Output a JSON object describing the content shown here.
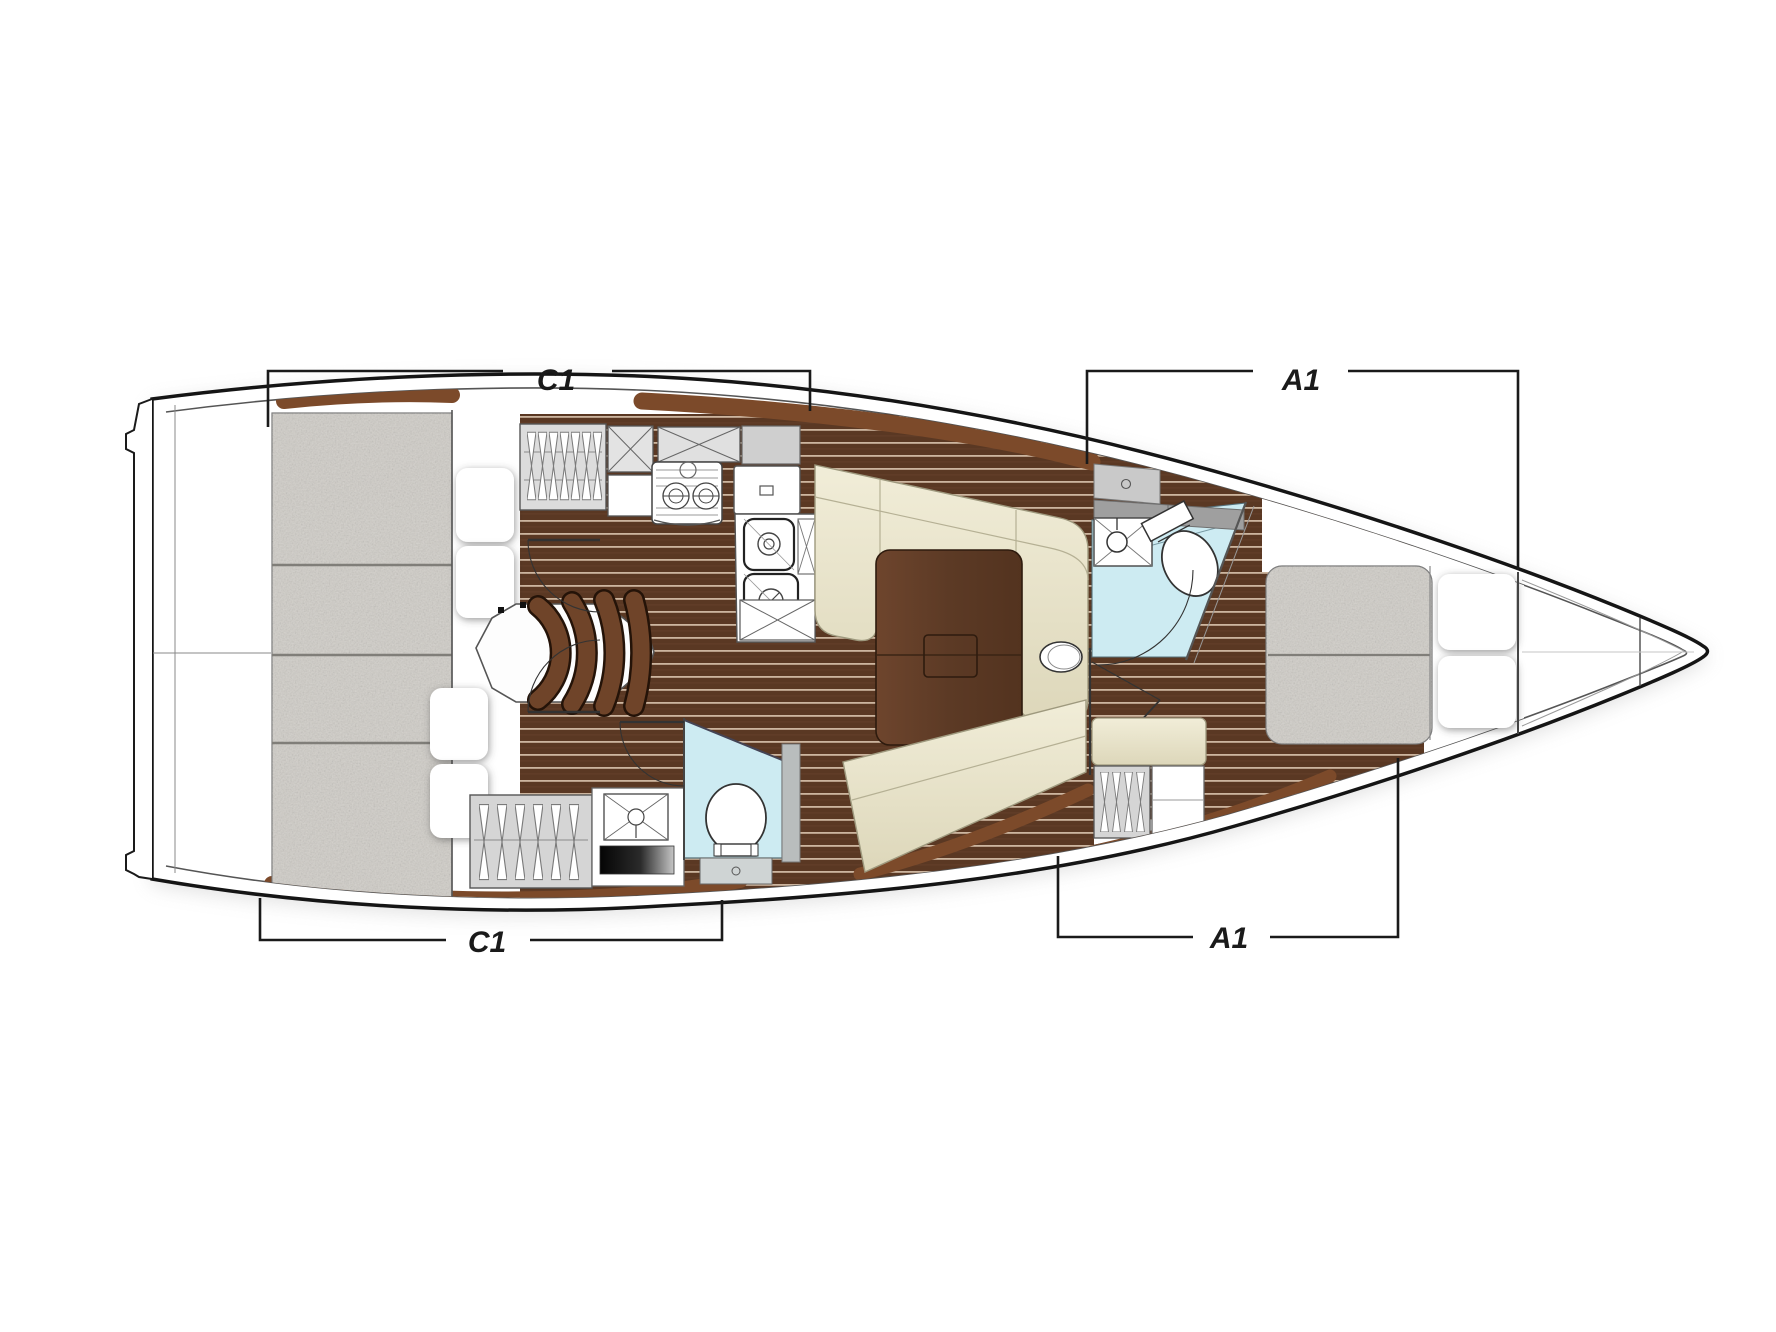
{
  "plan": {
    "type": "sailing-yacht-interior-floor-plan-top-view",
    "labels": {
      "c1": "C1",
      "a1": "A1"
    },
    "brackets": [
      {
        "id": "top-aft",
        "label": "C1",
        "side": "top"
      },
      {
        "id": "top-fore",
        "label": "A1",
        "side": "top"
      },
      {
        "id": "bottom-aft",
        "label": "C1",
        "side": "bottom"
      },
      {
        "id": "bottom-fore",
        "label": "A1",
        "side": "bottom"
      }
    ],
    "colors": {
      "hull_outline": "#151515",
      "wood_floor": "#5a3823",
      "wood_plank_line": "#d9c4ad",
      "wood_trim": "#7c4a2a",
      "table_wood": "#64402a",
      "upholstery_cream": "#ece8d0",
      "mattress_gray": "#d0cdc7",
      "head_floor_blue": "#cdebf2",
      "locker_gray": "#d7d7d7",
      "background": "#ffffff"
    }
  }
}
